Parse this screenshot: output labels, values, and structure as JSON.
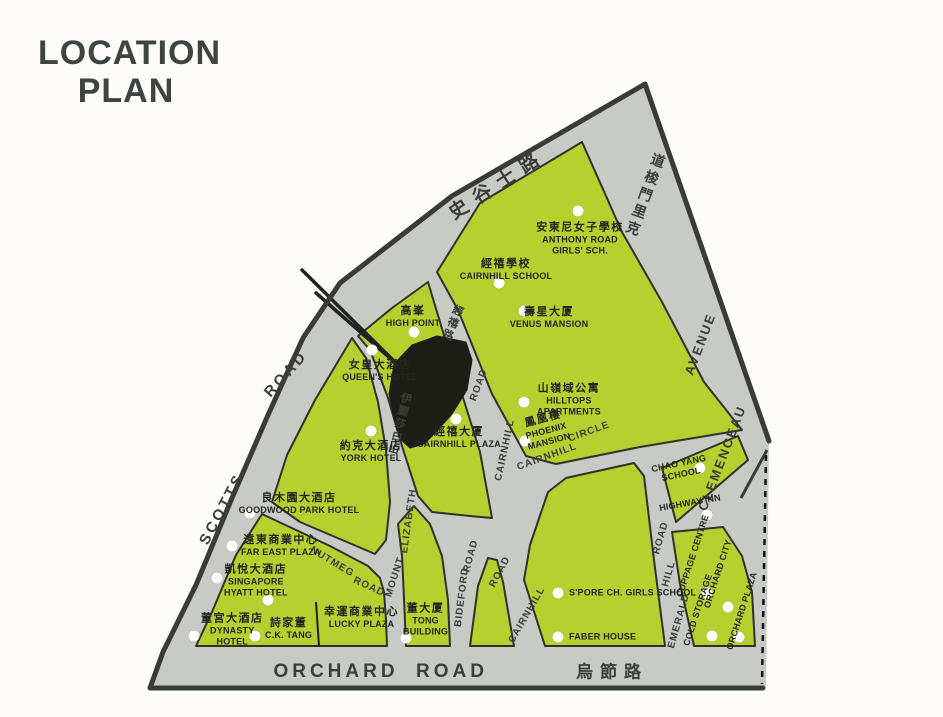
{
  "title": {
    "line1": "LOCATION",
    "line2": "PLAN"
  },
  "colors": {
    "page_bg": "#fdfcf9",
    "map_gray": "#c8cac5",
    "block_green": "#b6d02f",
    "border_dark": "#383c33",
    "building_black": "#1d1d18",
    "dot_white": "#ffffff",
    "text_dark": "#23261e",
    "road_text": "#3a3e36",
    "title_color": "#3e443f"
  },
  "map": {
    "road_labels": [
      {
        "id": "scotts-road-cn",
        "text": "史谷士路",
        "x": 497,
        "y": 183,
        "rot": -33,
        "k": "cnbig"
      },
      {
        "id": "scotts-road-en-1",
        "text": "SCOTTS",
        "x": 222,
        "y": 509,
        "rot": -62,
        "k": "big"
      },
      {
        "id": "scotts-road-en-2",
        "text": "ROAD",
        "x": 286,
        "y": 374,
        "rot": -48,
        "k": "big"
      },
      {
        "id": "clemenceau-ave-cn",
        "text": "克里門梭道",
        "x": 645,
        "y": 196,
        "rot": 20,
        "k": "cnvert",
        "reverse": true
      },
      {
        "id": "clemenceau-ave-en-1",
        "text": "CLEMENCEAU",
        "x": 722,
        "y": 458,
        "rot": -69,
        "k": "med"
      },
      {
        "id": "clemenceau-ave-en-2",
        "text": "AVENUE",
        "x": 700,
        "y": 344,
        "rot": -69,
        "k": "med"
      },
      {
        "id": "cairnhill-road-cn",
        "text": "經禧路",
        "x": 452,
        "y": 323,
        "rot": 22,
        "k": "cnvert-sm"
      },
      {
        "id": "mt-elizabeth-cn",
        "text": "伊麗莎白山",
        "x": 399,
        "y": 424,
        "rot": 14,
        "k": "cnvert-sm"
      },
      {
        "id": "cairnhill-road-up-2",
        "text": "ROAD",
        "x": 479,
        "y": 385,
        "rot": -70,
        "k": "sm"
      },
      {
        "id": "cairnhill-road-up-1",
        "text": "CAIRNHILL",
        "x": 505,
        "y": 450,
        "rot": -78,
        "k": "sm"
      },
      {
        "id": "cairnhill-road-lo-1",
        "text": "CAIRNHILL",
        "x": 527,
        "y": 615,
        "rot": -60,
        "k": "sm"
      },
      {
        "id": "cairnhill-road-lo-2",
        "text": "ROAD",
        "x": 500,
        "y": 572,
        "rot": -62,
        "k": "sm"
      },
      {
        "id": "cairnhill-circle-1",
        "text": "CAIRNHILL",
        "x": 547,
        "y": 457,
        "rot": -20,
        "k": "sm"
      },
      {
        "id": "cairnhill-circle-2",
        "text": "CIRCLE",
        "x": 589,
        "y": 432,
        "rot": -20,
        "k": "sm"
      },
      {
        "id": "mount-elizabeth-1",
        "text": "MOUNT",
        "x": 395,
        "y": 577,
        "rot": -72,
        "k": "sm"
      },
      {
        "id": "mount-elizabeth-2",
        "text": "ELIZABETH",
        "x": 409,
        "y": 521,
        "rot": -82,
        "k": "sm"
      },
      {
        "id": "nutmeg-road-1",
        "text": "NUTMEG",
        "x": 332,
        "y": 562,
        "rot": 31,
        "k": "sm"
      },
      {
        "id": "nutmeg-road-2",
        "text": "ROAD",
        "x": 369,
        "y": 587,
        "rot": 25,
        "k": "sm"
      },
      {
        "id": "bideford-road-1",
        "text": "BIDEFORD",
        "x": 462,
        "y": 597,
        "rot": -83,
        "k": "sm"
      },
      {
        "id": "bideford-road-2",
        "text": "ROAD",
        "x": 471,
        "y": 556,
        "rot": -75,
        "k": "sm"
      },
      {
        "id": "emerald-hill-1",
        "text": "EMERALD",
        "x": 679,
        "y": 621,
        "rot": -74,
        "k": "sm"
      },
      {
        "id": "emerald-hill-2",
        "text": "HILL",
        "x": 669,
        "y": 574,
        "rot": -74,
        "k": "sm"
      },
      {
        "id": "emerald-hill-3",
        "text": "ROAD",
        "x": 661,
        "y": 538,
        "rot": -74,
        "k": "sm"
      },
      {
        "id": "orchard-road-en-1",
        "text": "ORCHARD",
        "x": 336,
        "y": 672,
        "rot": 0,
        "k": "orchard"
      },
      {
        "id": "orchard-road-en-2",
        "text": "ROAD",
        "x": 452,
        "y": 672,
        "rot": 0,
        "k": "orchard"
      },
      {
        "id": "orchard-road-cn",
        "text": "烏節路",
        "x": 612,
        "y": 670,
        "rot": 0,
        "k": "cnorchard"
      }
    ],
    "places": [
      {
        "id": "anthony-road-girls-school",
        "cn": "安東尼女子學校",
        "en": "ANTHONY ROAD\nGIRLS' SCH.",
        "label": {
          "x": 580,
          "y": 239
        },
        "dot": {
          "x": 578,
          "y": 211
        }
      },
      {
        "id": "cairnhill-school",
        "cn": "經禧學校",
        "en": "CAIRNHILL SCHOOL",
        "label": {
          "x": 506,
          "y": 270
        },
        "dot": {
          "x": 499,
          "y": 283
        }
      },
      {
        "id": "venus-mansion",
        "cn": "壽星大厦",
        "en": "VENUS MANSION",
        "label": {
          "x": 549,
          "y": 318
        },
        "dot": {
          "x": 524,
          "y": 311
        }
      },
      {
        "id": "hilltops-apartments",
        "cn": "山嶺域公寓",
        "en": "HILLTOPS\nAPARTMENTS",
        "label": {
          "x": 537,
          "y": 400,
          "anchor": "left"
        },
        "dot": {
          "x": 524,
          "y": 402
        }
      },
      {
        "id": "phoenix-mansion",
        "cn": "鳳凰樓",
        "en": "PHOENIX\nMANSION",
        "label": {
          "x": 546,
          "y": 430,
          "rot": -15
        },
        "dot": {
          "x": 525,
          "y": 441
        }
      },
      {
        "id": "high-point",
        "cn": "高峯",
        "en": "HIGH POINT",
        "label": {
          "x": 413,
          "y": 317
        },
        "dot": {
          "x": 414,
          "y": 332
        }
      },
      {
        "id": "queens-hotel",
        "cn": "女皇大酒店",
        "en": "QUEEN'S HOTEL",
        "label": {
          "x": 380,
          "y": 371
        },
        "dot": {
          "x": 372,
          "y": 350
        }
      },
      {
        "id": "york-hotel",
        "cn": "約克大酒店",
        "en": "YORK  HOTEL",
        "label": {
          "x": 371,
          "y": 452
        },
        "dot": {
          "x": 371,
          "y": 431
        }
      },
      {
        "id": "cairnhill-plaza",
        "cn": "經禧大厦",
        "en": "CAIRNHILL PLAZA",
        "label": {
          "x": 459,
          "y": 438
        },
        "dot": {
          "x": 456,
          "y": 419
        }
      },
      {
        "id": "goodwood-park-hotel",
        "cn": "良木園大酒店",
        "en": "GOODWOOD PARK HOTEL",
        "label": {
          "x": 299,
          "y": 504
        },
        "dot": {
          "x": 250,
          "y": 513
        }
      },
      {
        "id": "far-east-plaza",
        "cn": "遠東商業中心",
        "en": "FAR EAST PLAZA",
        "label": {
          "x": 241,
          "y": 546,
          "anchor": "left"
        },
        "dot": {
          "x": 232,
          "y": 546
        }
      },
      {
        "id": "singapore-hyatt-hotel",
        "cn": "凱悅大酒店",
        "en": "SINGAPORE\nHYATT HOTEL",
        "label": {
          "x": 224,
          "y": 581,
          "anchor": "left"
        },
        "dot": {
          "x": 217,
          "y": 578
        }
      },
      {
        "id": "dynasty-hotel",
        "cn": "董宮大酒店",
        "en": "DYNASTY\nHOTEL",
        "label": {
          "x": 201,
          "y": 630,
          "anchor": "left"
        },
        "dot": {
          "x": 194,
          "y": 636
        }
      },
      {
        "id": "ck-tang",
        "cn": "詩家董",
        "en": "C.K. TANG",
        "label": {
          "x": 265,
          "y": 629,
          "anchor": "left"
        },
        "dot": {
          "x": 255,
          "y": 636
        }
      },
      {
        "id": "lucky-plaza",
        "cn": "幸運商業中心",
        "en": "LUCKY PLAZA",
        "label": {
          "x": 324,
          "y": 618,
          "anchor": "left"
        }
      },
      {
        "id": "tong-building",
        "cn": "董大厦",
        "en": "TONG\nBUILDING",
        "label": {
          "x": 403,
          "y": 620,
          "anchor": "left"
        },
        "dot": {
          "x": 406,
          "y": 638
        }
      },
      {
        "id": "spore-ch-girls-school",
        "cn": "",
        "en": "S'PORE CH. GIRLS SCHOOL",
        "label": {
          "x": 569,
          "y": 593,
          "anchor": "left"
        },
        "dot": {
          "x": 558,
          "y": 593
        }
      },
      {
        "id": "faber-house",
        "cn": "",
        "en": "FABER HOUSE",
        "label": {
          "x": 569,
          "y": 637,
          "anchor": "left"
        },
        "dot": {
          "x": 558,
          "y": 637
        }
      },
      {
        "id": "chao-yang-school",
        "cn": "",
        "en": "CHAO YANG\nSCHOOL",
        "label": {
          "x": 680,
          "y": 469,
          "rot": -12
        },
        "dot": {
          "x": 700,
          "y": 468
        }
      },
      {
        "id": "highway-inn",
        "cn": "",
        "en": "HIGHWAY INN",
        "label": {
          "x": 690,
          "y": 503,
          "rot": -10
        },
        "dot": {
          "x": 707,
          "y": 515
        }
      },
      {
        "id": "cold-storage",
        "cn": "",
        "en": "COLD STORAGE",
        "label": {
          "x": 698,
          "y": 610,
          "rot": -72
        },
        "dot": {
          "x": 712,
          "y": 636
        }
      },
      {
        "id": "cuppage-centre",
        "cn": "",
        "en": "CUPPAGE CENTRE",
        "label": {
          "x": 693,
          "y": 556,
          "rot": -72
        },
        "dot": {
          "x": 707,
          "y": 593
        }
      },
      {
        "id": "orchard-city",
        "cn": "",
        "en": "ORCHARD CITY",
        "label": {
          "x": 718,
          "y": 574,
          "rot": -72
        },
        "dot": {
          "x": 728,
          "y": 607
        }
      },
      {
        "id": "orchard-plaza",
        "cn": "",
        "en": "ORCHARD PLAZA",
        "label": {
          "x": 742,
          "y": 611,
          "rot": -72
        },
        "dot": {
          "x": 739,
          "y": 637
        }
      },
      {
        "id": "unlabeled-marker",
        "cn": "",
        "en": "",
        "dot": {
          "x": 268,
          "y": 600
        }
      }
    ]
  }
}
